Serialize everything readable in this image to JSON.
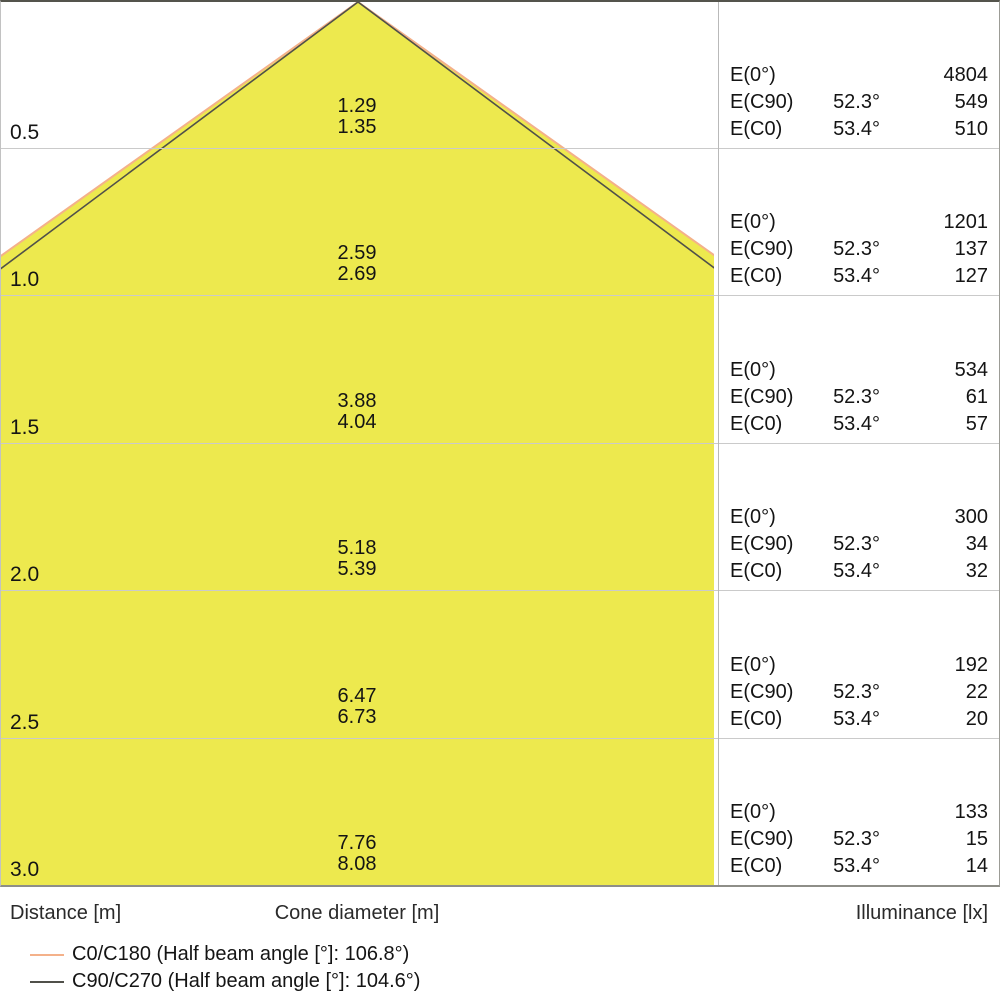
{
  "axis": {
    "distance_label": "Distance [m]",
    "cone_label": "Cone diameter [m]",
    "illuminance_label": "Illuminance [lx]"
  },
  "table": {
    "e0_label": "E(0°)",
    "ec90_label": "E(C90)",
    "ec0_label": "E(C0)",
    "ec90_angle": "52.3°",
    "ec0_angle": "53.4°"
  },
  "rows": [
    {
      "distance": "0.5",
      "cone_c90": "1.29",
      "cone_c0": "1.35",
      "e0": "4804",
      "ec90": "549",
      "ec0": "510"
    },
    {
      "distance": "1.0",
      "cone_c90": "2.59",
      "cone_c0": "2.69",
      "e0": "1201",
      "ec90": "137",
      "ec0": "127"
    },
    {
      "distance": "1.5",
      "cone_c90": "3.88",
      "cone_c0": "4.04",
      "e0": "534",
      "ec90": "61",
      "ec0": "57"
    },
    {
      "distance": "2.0",
      "cone_c90": "5.18",
      "cone_c0": "5.39",
      "e0": "300",
      "ec90": "34",
      "ec0": "32"
    },
    {
      "distance": "2.5",
      "cone_c90": "6.47",
      "cone_c0": "6.73",
      "e0": "192",
      "ec90": "22",
      "ec0": "20"
    },
    {
      "distance": "3.0",
      "cone_c90": "7.76",
      "cone_c0": "8.08",
      "e0": "133",
      "ec90": "15",
      "ec0": "14"
    }
  ],
  "legend": {
    "c0_label": "C0/C180 (Half beam angle [°]: 106.8°)",
    "c90_label": "C90/C270 (Half beam angle [°]: 104.6°)"
  },
  "colors": {
    "cone_fill": "#ede94e",
    "c0_line": "#f4b18a",
    "c90_line": "#50504a"
  },
  "chart_data": {
    "type": "area",
    "title": "Light cone diagram (luminaire photometrics)",
    "xlabel": "Cone diameter [m]",
    "ylabel": "Distance [m]",
    "distances_m": [
      0.5,
      1.0,
      1.5,
      2.0,
      2.5,
      3.0
    ],
    "series": [
      {
        "name": "C0/C180",
        "half_beam_angle_deg": 106.8,
        "angle_label": "53.4°",
        "cone_diameter_m": [
          1.35,
          2.69,
          4.04,
          5.39,
          6.73,
          8.08
        ],
        "illuminance_lx": [
          510,
          127,
          57,
          32,
          20,
          14
        ]
      },
      {
        "name": "C90/C270",
        "half_beam_angle_deg": 104.6,
        "angle_label": "52.3°",
        "cone_diameter_m": [
          1.29,
          2.59,
          3.88,
          5.18,
          6.47,
          7.76
        ],
        "illuminance_lx": [
          549,
          137,
          61,
          34,
          22,
          15
        ]
      },
      {
        "name": "E(0°)",
        "illuminance_lx": [
          4804,
          1201,
          534,
          300,
          192,
          133
        ]
      }
    ],
    "legend_position": "bottom",
    "grid": true
  }
}
